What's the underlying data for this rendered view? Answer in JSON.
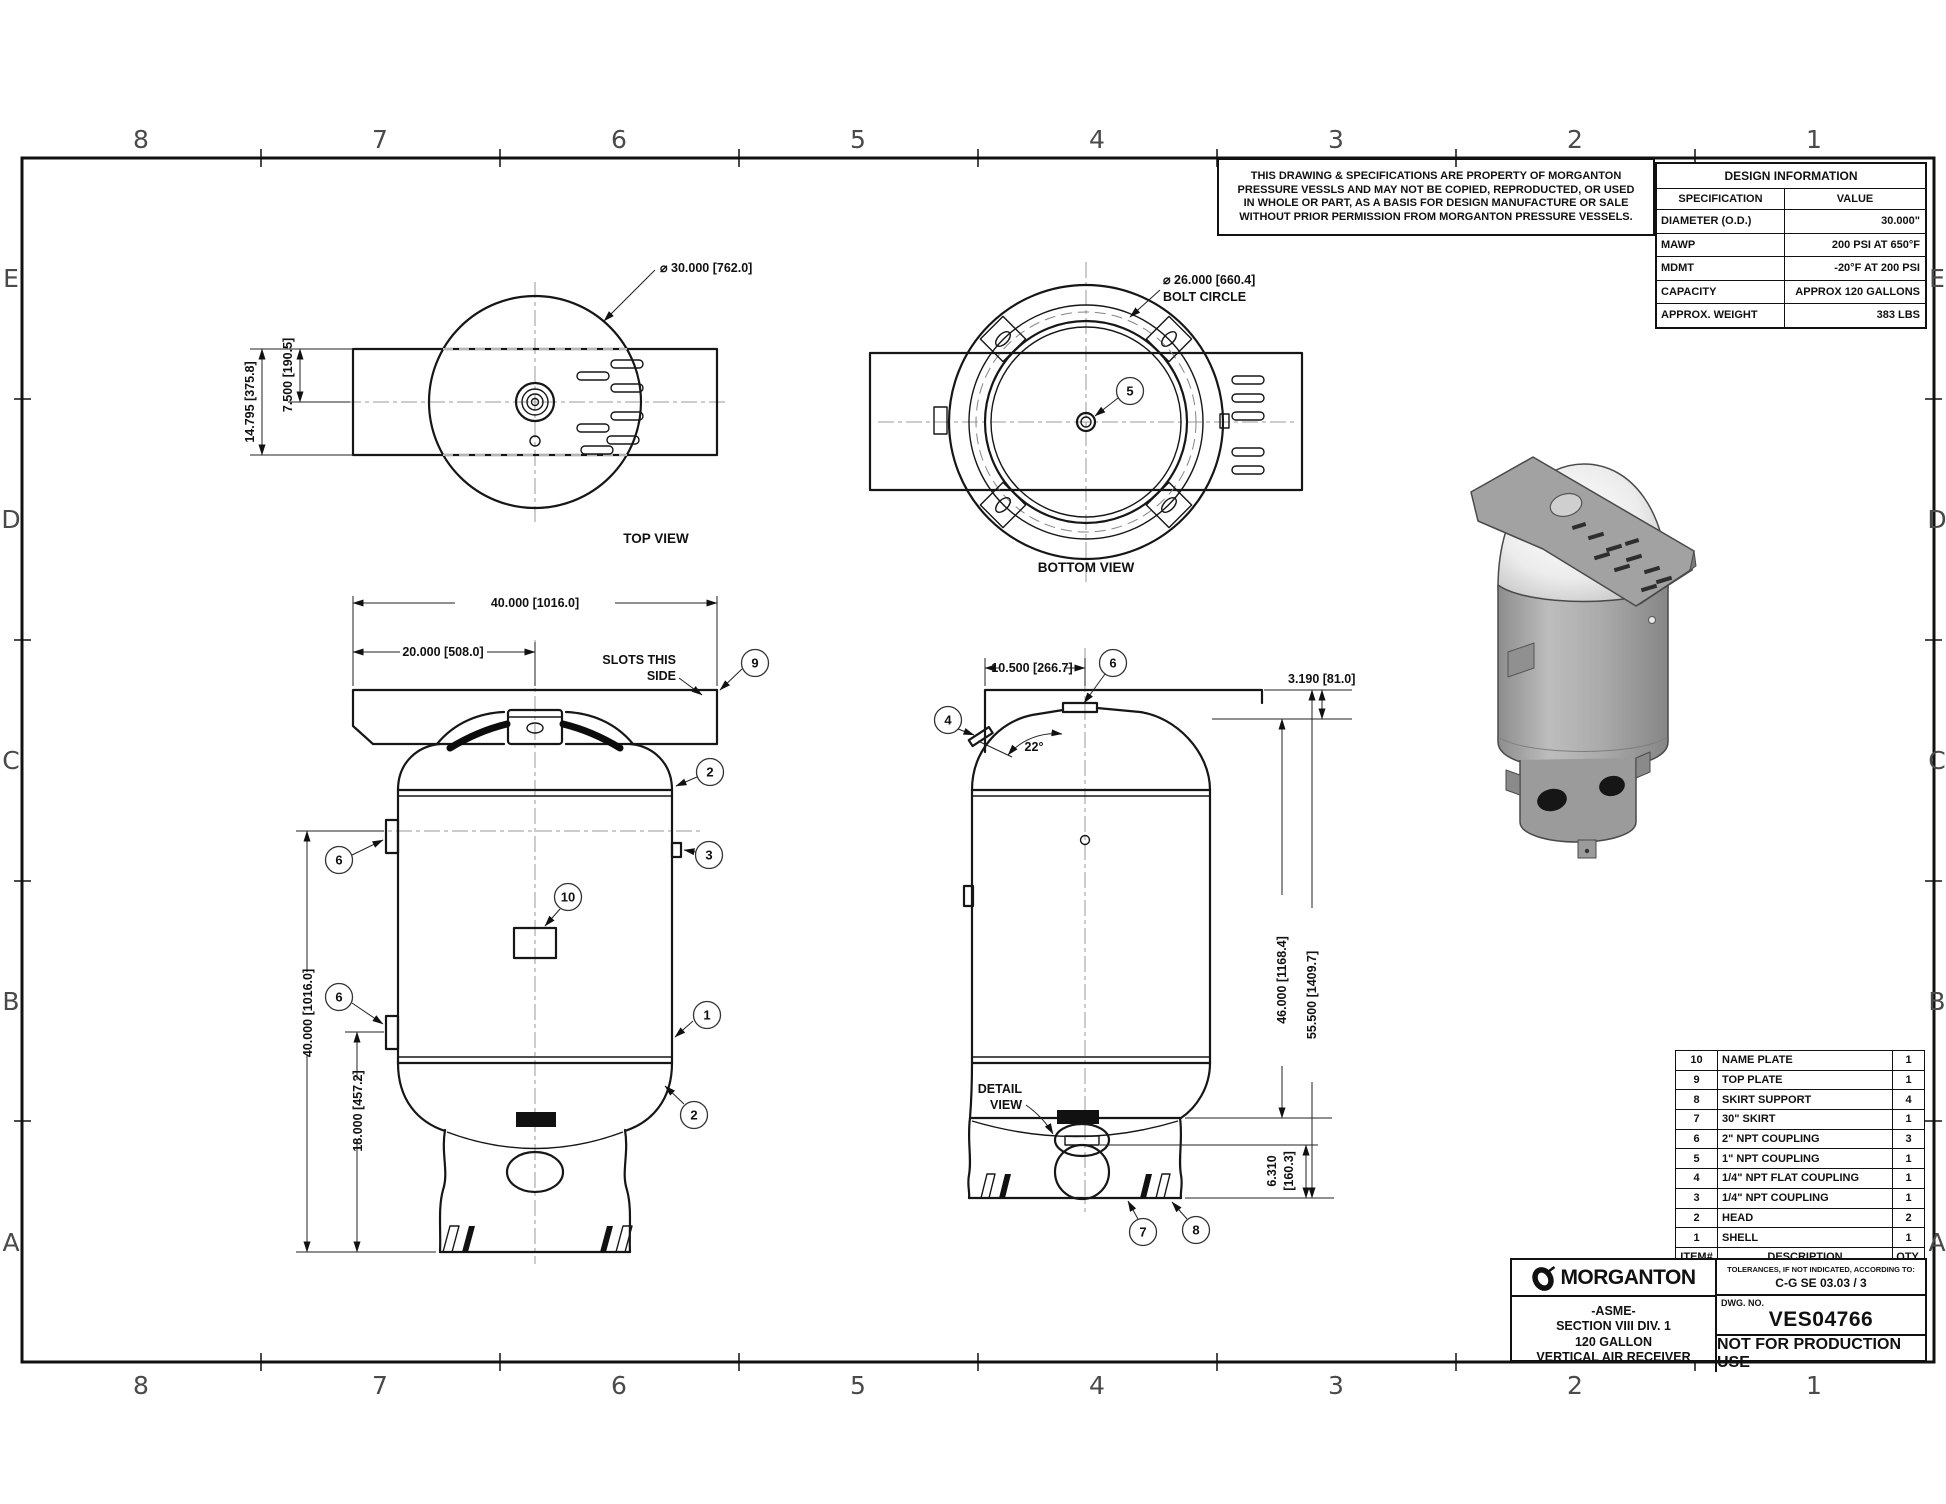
{
  "drawing": {
    "grid": {
      "cols": [
        "8",
        "7",
        "6",
        "5",
        "4",
        "3",
        "2",
        "1"
      ],
      "rows": [
        "E",
        "D",
        "C",
        "B",
        "A"
      ]
    },
    "notice": {
      "l1": "THIS DRAWING & SPECIFICATIONS ARE PROPERTY OF MORGANTON",
      "l2": "PRESSURE VESSLS AND MAY NOT BE COPIED, REPRODUCTED,  OR USED",
      "l3": "IN WHOLE OR PART, AS A BASIS FOR DESIGN MANUFACTURE OR SALE",
      "l4": "WITHOUT PRIOR PERMISSION FROM MORGANTON PRESSURE VESSELS."
    }
  },
  "design_info": {
    "title": "DESIGN INFORMATION",
    "col_spec": "SPECIFICATION",
    "col_value": "VALUE",
    "rows": [
      {
        "spec": "DIAMETER (O.D.)",
        "value": "30.000\""
      },
      {
        "spec": "MAWP",
        "value": "200 PSI AT 650°F"
      },
      {
        "spec": "MDMT",
        "value": "-20°F AT 200 PSI"
      },
      {
        "spec": "CAPACITY",
        "value": "APPROX 120 GALLONS"
      },
      {
        "spec": "APPROX. WEIGHT",
        "value": "383 LBS"
      }
    ]
  },
  "parts_list": {
    "header": {
      "item": "ITEM#",
      "desc": "DESCRIPTION",
      "qty": "QTY."
    },
    "rows": [
      {
        "item": "10",
        "desc": "NAME PLATE",
        "qty": "1"
      },
      {
        "item": "9",
        "desc": "TOP PLATE",
        "qty": "1"
      },
      {
        "item": "8",
        "desc": "SKIRT SUPPORT",
        "qty": "4"
      },
      {
        "item": "7",
        "desc": "30\" SKIRT",
        "qty": "1"
      },
      {
        "item": "6",
        "desc": "2\" NPT COUPLING",
        "qty": "3"
      },
      {
        "item": "5",
        "desc": "1\" NPT COUPLING",
        "qty": "1"
      },
      {
        "item": "4",
        "desc": "1/4\" NPT FLAT COUPLING",
        "qty": "1"
      },
      {
        "item": "3",
        "desc": "1/4\" NPT COUPLING",
        "qty": "1"
      },
      {
        "item": "2",
        "desc": "HEAD",
        "qty": "2"
      },
      {
        "item": "1",
        "desc": "SHELL",
        "qty": "1"
      }
    ]
  },
  "title_block": {
    "brand": "MORGANTON",
    "lines": [
      "-ASME-",
      "SECTION VIII DIV. 1",
      "120 GALLON",
      "VERTICAL AIR RECEIVER"
    ],
    "tol_label": "TOLERANCES, IF NOT INDICATED, ACCORDING TO:",
    "tol_value": "C-G SE 03.03 / 3",
    "dwg_label": "DWG. NO.",
    "dwg_no": "VES04766",
    "status": "NOT FOR PRODUCTION USE"
  },
  "views": {
    "top": {
      "name": "TOP VIEW",
      "dim_diameter": "⌀ 30.000 [762.0]",
      "dim_offset": "7.500 [190.5]",
      "dim_plate": "14.795 [375.8]"
    },
    "bottom": {
      "name": "BOTTOM VIEW",
      "bolt_dia": "⌀ 26.000 [660.4]",
      "bolt_label": "BOLT CIRCLE"
    },
    "front": {
      "dim_plate_w": "40.000 [1016.0]",
      "dim_plate_half": "20.000 [508.0]",
      "slots_note_1": "SLOTS THIS",
      "slots_note_2": "SIDE",
      "dim_height": "40.000 [1016.0]",
      "dim_lower": "18.000 [457.2]"
    },
    "side": {
      "dim_top": "10.500 [266.7]",
      "dim_angle": "22°",
      "dim_plate_rise": "3.190 [81.0]",
      "dim_shell": "46.000 [1168.4]",
      "dim_overall": "55.500 [1409.7]",
      "dim_skirt_a": "6.310",
      "dim_skirt_b": "[160.3]",
      "detail_1": "DETAIL",
      "detail_2": "VIEW"
    }
  },
  "balloons": {
    "b1": "1",
    "b2": "2",
    "b3": "3",
    "b4": "4",
    "b5": "5",
    "b6": "6",
    "b7": "7",
    "b8": "8",
    "b9": "9",
    "b10": "10"
  }
}
